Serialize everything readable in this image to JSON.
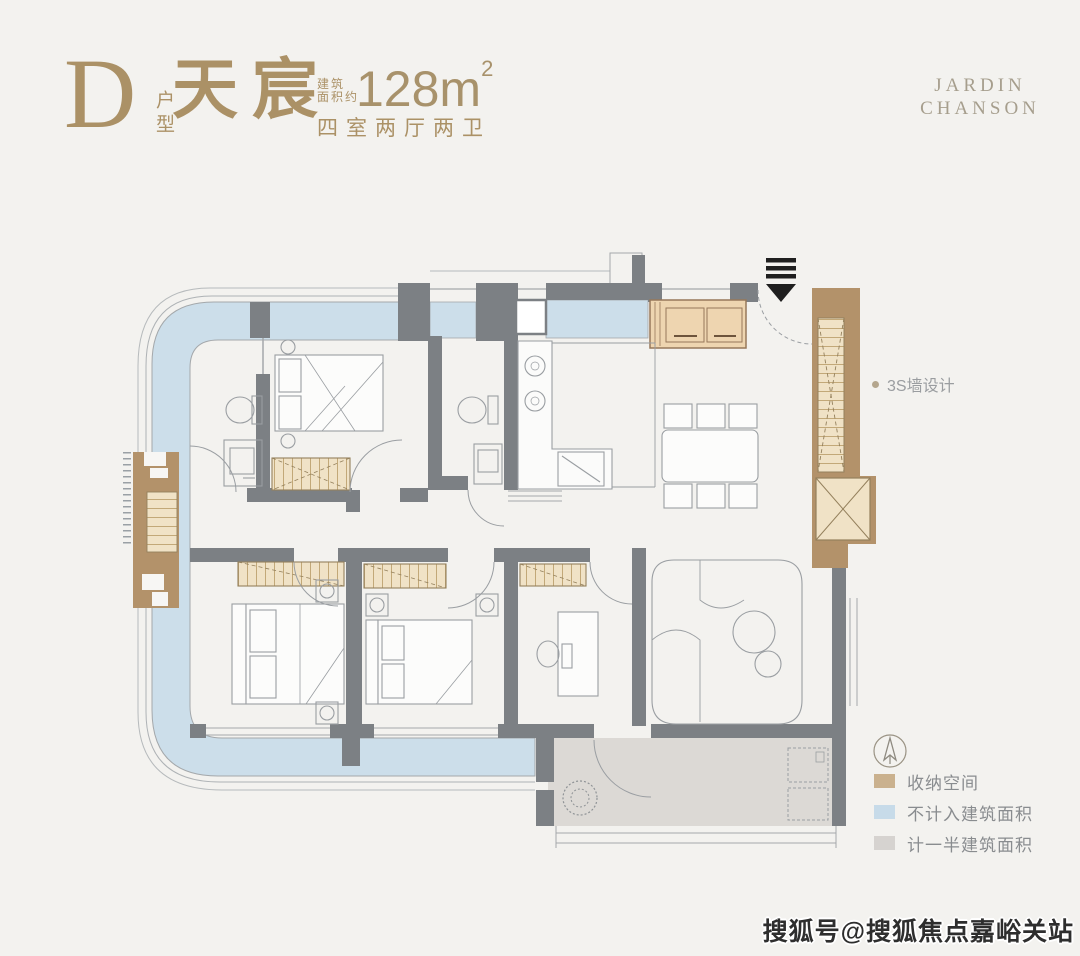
{
  "header": {
    "unit_letter": "D",
    "unit_letter_sub": "户型",
    "unit_name": "天宸",
    "area_prefix_line1": "建筑",
    "area_prefix_line2": "面积约",
    "area_value": "128m",
    "area_exponent": "2",
    "layout_spec": "四室两厅两卫"
  },
  "brand": {
    "line1": "JARDIN",
    "line2": "CHANSON"
  },
  "plan": {
    "annotation_3s": "3S墙设计"
  },
  "legend": {
    "items": [
      {
        "label": "收纳空间",
        "color": "#cab18e"
      },
      {
        "label": "不计入建筑面积",
        "color": "#c7dbe9"
      },
      {
        "label": "计一半建筑面积",
        "color": "#d6d3d0"
      }
    ]
  },
  "watermark": {
    "text": "搜狐号@搜狐焦点嘉峪关站"
  },
  "colors": {
    "accent_gold": "#ab9166",
    "wall_gray": "#7c8084",
    "storage_tan": "#b3926a",
    "balcony_blue": "#ccdeea",
    "half_area_gray": "#dcd9d5",
    "background": "#f3f2ef"
  }
}
